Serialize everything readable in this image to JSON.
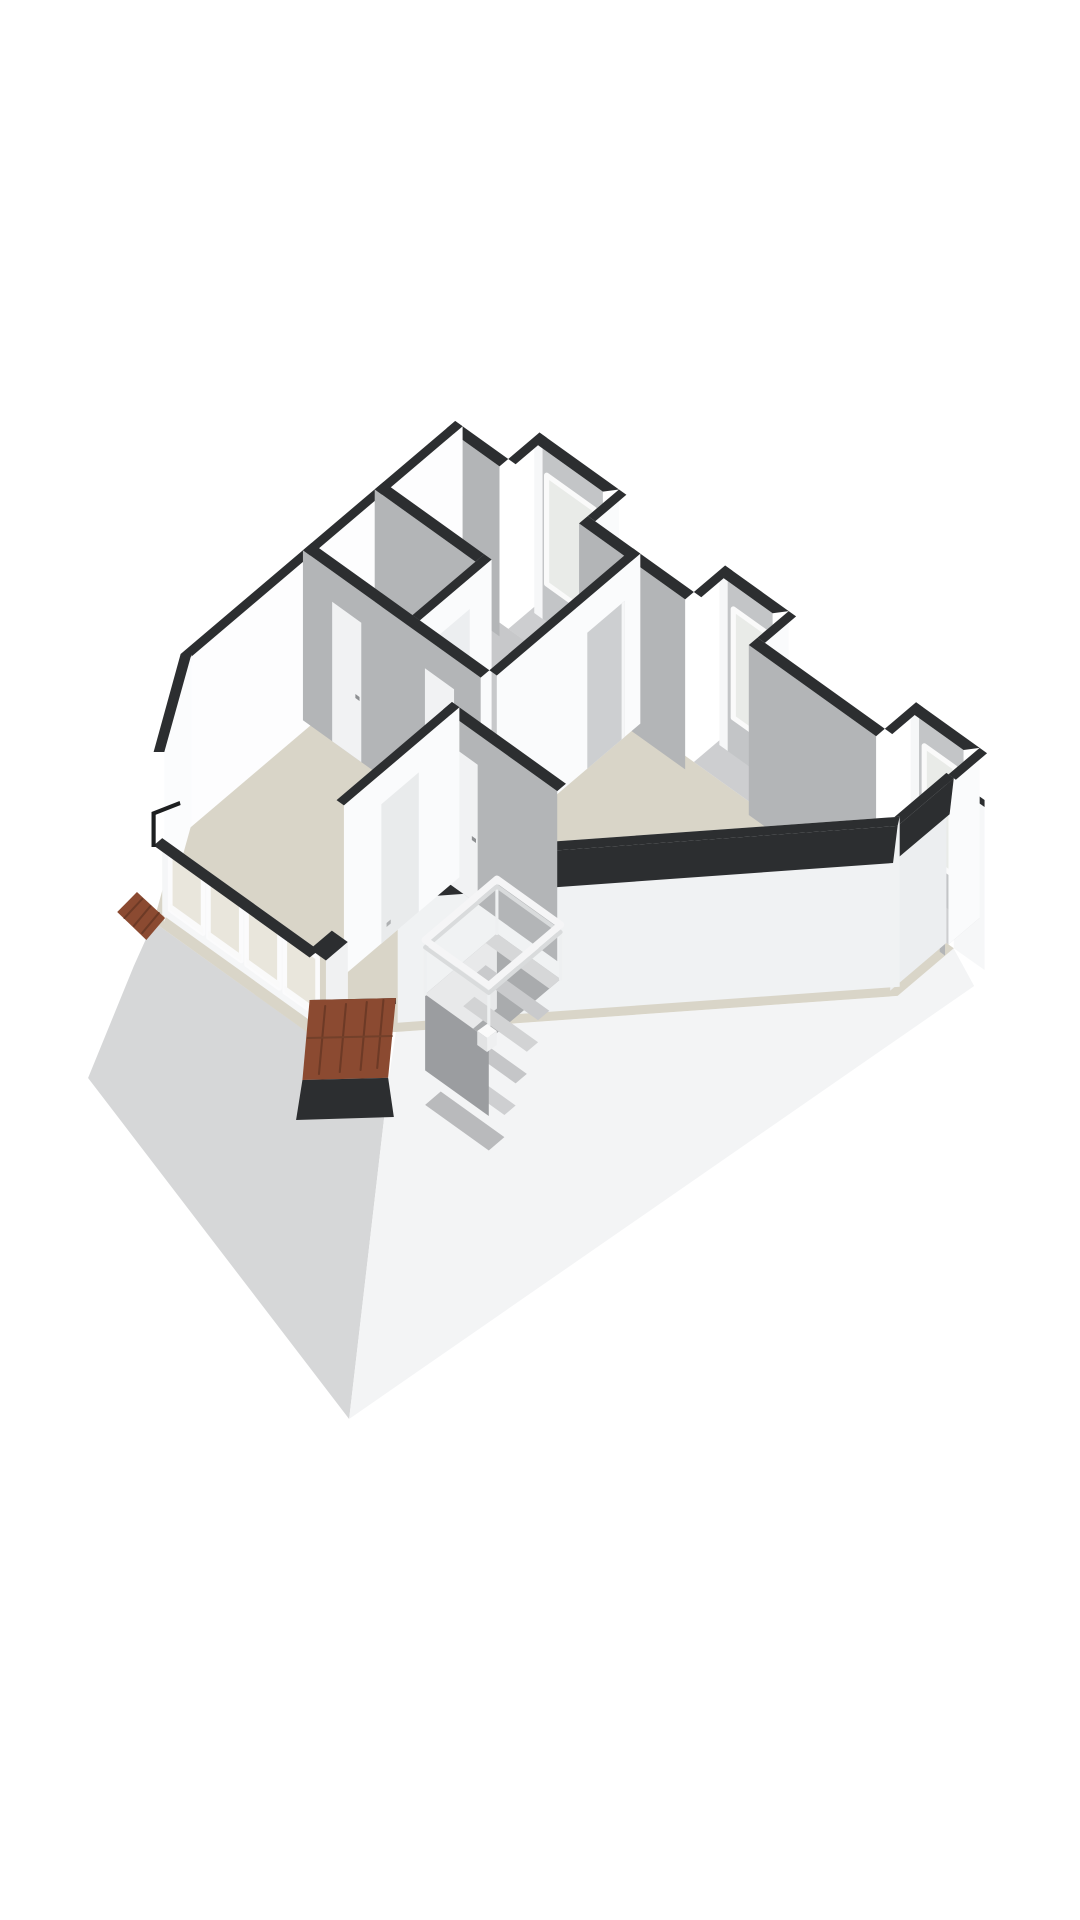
{
  "page": {
    "background": "#ffffff",
    "title": "3D floor plan rendering"
  },
  "palette": {
    "wall_cap_dark": "#2c2e30",
    "wall_white": "#fbfcfd",
    "wall_gray": "#b3b5b7",
    "floor_beige": "#d9d5c8",
    "floor_shadow_gray": "#c7c8ca",
    "roof_tiles_terracotta": "#8b4a31",
    "glass": "#e9e6dc",
    "railing_white": "#f5f5f6",
    "exterior_skirt_white": "#f3f4f5",
    "exterior_skirt_gray": "#d6d7d8"
  },
  "scene": {
    "width": 1080,
    "height": 1920,
    "transform": "translate(-70,6) scale(1.04,1)",
    "shapes": [
      {
        "n": "exterior-skirt-southwest",
        "f": "#d6d7d8",
        "p": "215,916 368,1030 441,1073 403,1413 152,1072 196,960"
      },
      {
        "n": "exterior-skirt-southeast",
        "f": "#f3f4f5",
        "p": "984,942 1004,980 403,1413 441,1073 448,1026 930,990"
      },
      {
        "n": "exterior-face-right",
        "f": "#f6f7f8",
        "p": "984.4,942.2 984.4,772.2 1014,794 1014,964"
      },
      {
        "n": "exterior-cap-right",
        "f": "#2c2e30",
        "p": "984.4,772.2 1014,794 1014,801 984.4,779.2"
      },
      {
        "n": "floor-slab",
        "f": "#d9d5c8",
        "p": "505,585 984.4,942.2 930.4,989.9 448,1026 365,1028 215,916 241,818"
      },
      {
        "n": "floor-small-rooms",
        "f": "#c7c8ca",
        "p": "505,585 676,712 538,834 367,707"
      },
      {
        "n": "dormer-a-floor",
        "f": "#cdced0",
        "p": "586,596.5 662.5,653.5 632.5,680 556,623"
      },
      {
        "n": "dormer-a-back-wall",
        "f": "#c3c5c7",
        "p": "584.7,609.2 647,655.6 647,485.6 584.7,439.2"
      },
      {
        "n": "dormer-a-window",
        "f": "#e9ebe8",
        "s": "#fafafa",
        "w": 5,
        "p": "592.9,577.9 638.8,612.1 638.8,503.3 592.9,469.1"
      },
      {
        "n": "dormer-a-jamb",
        "f": "#f6f7f8",
        "p": "581,607 589,613 589,440 581,434"
      },
      {
        "n": "dormer-a-sidewall",
        "f": "#fafbfc",
        "p": "662.5,653.5 632.5,680 632.5,510 662.5,483.5"
      },
      {
        "n": "dormer-a-cap-front",
        "f": "#2c2e30",
        "p": "586,426.5 662.5,483.5 647,485.6 584.7,439.2"
      },
      {
        "n": "dormer-a-cap-left",
        "f": "#2c2e30",
        "p": "586,426.5 556,453 563.1,458.3 593.1,431.8"
      },
      {
        "n": "dormer-a-cap-right",
        "f": "#2c2e30",
        "p": "662.5,483.5 632.5,510 639.6,515.3 669.6,488.8"
      },
      {
        "n": "wall-ne-a-face",
        "f": "#b3b5b7",
        "p": "496.6,592.4 547.6,630.4 547.6,460.4 496.6,422.4"
      },
      {
        "n": "wall-ne-a-cap",
        "f": "#2c2e30",
        "p": "505,415 556,453 547.6,460.4 496.6,422.4"
      },
      {
        "n": "wall-ne-b-face",
        "f": "#b3b5b7",
        "p": "624.1,687.4 726.1,763.4 726.1,593.4 624.1,517.4"
      },
      {
        "n": "wall-ne-b-cap",
        "f": "#2c2e30",
        "p": "632.5,510 734.5,586 726.1,593.4 624.1,517.4"
      },
      {
        "n": "dormer-b-floor",
        "f": "#cdced0",
        "p": "764.5,729.5 841,786.5 811,813 734.5,756"
      },
      {
        "n": "dormer-b-back-wall",
        "f": "#c3c5c7",
        "p": "763.2,742.2 810.2,777.2 810.2,607.2 763.2,572.2"
      },
      {
        "n": "dormer-b-window",
        "f": "#e9ebe8",
        "s": "#fafafa",
        "w": 5,
        "p": "772.4,711.7 807.1,737.5 807.1,628.7 772.4,602.9"
      },
      {
        "n": "dormer-b-jamb",
        "f": "#f6f7f8",
        "p": "759,739 767,745 767,572 759,566"
      },
      {
        "n": "dormer-b-sidewall",
        "f": "#fafbfc",
        "p": "825.7,775.1 795.7,801.6 795.7,631.6 825.7,605.1"
      },
      {
        "n": "dormer-b-cap-front",
        "f": "#2c2e30",
        "p": "764.5,559.5 825.7,605.1 810.2,607.2 763.2,572.2"
      },
      {
        "n": "dormer-b-cap-left",
        "f": "#2c2e30",
        "p": "764.5,559.5 734.5,586 741.6,591.3 771.6,564.8"
      },
      {
        "n": "dormer-b-cap-right",
        "f": "#2c2e30",
        "p": "825.7,605.1 795.7,631.6 802.8,636.9 832.8,610.4"
      },
      {
        "n": "wall-ne-c-face",
        "f": "#b3b5b7",
        "p": "787.3,809 909.7,900.2 909.7,730.2 787.3,639"
      },
      {
        "n": "wall-ne-c-cap",
        "f": "#2c2e30",
        "p": "795.7,631.6 918.1,722.8 909.7,730.2 787.3,639"
      },
      {
        "n": "dormer-c-floor",
        "f": "#cdced0",
        "p": "948.1,866.3 1009.3,911.9 979.3,938.4 918.1,892.8"
      },
      {
        "n": "dormer-c-back-wall",
        "f": "#c3c5c7",
        "p": "946.8,879 993.8,914 993.8,744 946.8,709"
      },
      {
        "n": "dormer-c-window",
        "f": "#e9ebe8",
        "s": "#fafafa",
        "w": 5,
        "p": "956,848.5 985.6,870.5 985.6,761.7 956,739.7"
      },
      {
        "n": "dormer-c-jamb",
        "f": "#f6f7f8",
        "p": "943,876 951,882 951,709 943,703"
      },
      {
        "n": "dormer-c-sidewall",
        "f": "#fafbfc",
        "p": "1009.3,911.9 979.3,938.4 979.3,768.4 1009.3,741.9"
      },
      {
        "n": "dormer-c-cap-front",
        "f": "#2c2e30",
        "p": "948.1,696.3 1009.3,741.9 993.8,744 946.8,709"
      },
      {
        "n": "dormer-c-cap-left",
        "f": "#2c2e30",
        "p": "948.1,696.3 918.1,722.8 925.2,728.1 955.2,701.6"
      },
      {
        "n": "dormer-c-cap-right",
        "f": "#2c2e30",
        "p": "1009.3,741.9 979.3,768.4 986.4,773.7 1016.4,747.2"
      },
      {
        "n": "wall-ne-d-face",
        "f": "#b3b5b7",
        "p": "970.9,945.8 976,949.6 976,779.6 970.9,775.8"
      },
      {
        "n": "wall-ne-d-cap",
        "f": "#2c2e30",
        "p": "979.3,768.4 984.4,772.2 976,779.6 970.9,775.8"
      },
      {
        "n": "wall-se-face",
        "f": "#eceef0",
        "p": "977.3,936.9 923.3,984.6 923.3,814.6 977.3,766.9"
      },
      {
        "n": "wall-se-cap",
        "f": "#2c2e30",
        "p": "984.4,772.2 930.4,819.9 923.3,814.6 977.3,766.9"
      },
      {
        "n": "wall-se-cap-outer",
        "f": "#2c2e30",
        "p": "984.4,772.2 930.4,819.9 926,856 980.4,808.2"
      },
      {
        "n": "wall-bevel-se-face",
        "f": "#f0f2f3",
        "p": "932.4,980.7 449.7,1016.7 449.7,846.7 932.4,810.7"
      },
      {
        "n": "wall-bevel-se-cap",
        "f": "#2c2e30",
        "p": "930.4,819.9 448,856 449.7,846.7 932.4,810.7"
      },
      {
        "n": "wall-bevel-se-cap-outer",
        "f": "#2c2e30",
        "p": "930.4,819.9 448,856 444,893 926,857"
      },
      {
        "n": "wall-nw-face",
        "f": "#fdfdfe",
        "p": "512.1,590.3 248.1,823.5 248.1,653.5 512.1,420.3"
      },
      {
        "n": "wall-nw-cap",
        "f": "#2c2e30",
        "p": "505,415 241,648 248.1,653.5 512.1,420.3"
      },
      {
        "n": "wall-bevel-left-face",
        "f": "#fbfcfd",
        "p": "251.4,818.2 225.3,916 225.3,746 251.4,648.2"
      },
      {
        "n": "wall-bevel-left-cap",
        "f": "#2c2e30",
        "p": "241,648 215,746 225.3,746 251.4,648.2"
      },
      {
        "n": "roof-tiles-left",
        "f": "#8b4a31",
        "p": "199,886 226,912 208,934 180,906"
      },
      {
        "n": "roof-tiles-left-ridge-1",
        "f": "none",
        "s": "#6d3a26",
        "w": 2,
        "p": "204,893 187,912"
      },
      {
        "n": "roof-tiles-left-ridge-2",
        "f": "none",
        "s": "#6d3a26",
        "w": 2,
        "p": "212,900 196,920"
      },
      {
        "n": "roof-tiles-left-ridge-3",
        "f": "none",
        "s": "#6d3a26",
        "w": 2,
        "p": "220,907 204,927"
      },
      {
        "n": "wall-small-rooms-divider-face",
        "f": "#b3b5b7",
        "p": "427.6,653.4 524.5,725.6 524.5,555.6 427.6,483.4"
      },
      {
        "n": "wall-small-rooms-divider-cap",
        "f": "#2c2e30",
        "p": "436,476 532.9,548.2 524.5,555.6 427.6,483.4"
      },
      {
        "n": "wall-small-rooms-return-face",
        "f": "#fafbfc",
        "p": "540,723.5 471,784.4 471,614.4 540,553.5"
      },
      {
        "n": "wall-small-rooms-return-cap",
        "f": "#2c2e30",
        "p": "532.9,548.2 463.9,609.1 471,614.4 540,553.5"
      },
      {
        "n": "door-small-room",
        "f": "#eceef0",
        "p": "519,742 489,768.5 489,629.5 519,603"
      },
      {
        "n": "door-small-room-handle",
        "f": "#9a9c9e",
        "p": "493,749 497,745.5 497,741.5 493,745"
      },
      {
        "n": "wall-partition-main-face",
        "f": "#fafbfc",
        "p": "683,717.6 545,839.5 545,669.5 683,547.6"
      },
      {
        "n": "doorway-opening",
        "f": "#cdcfd1",
        "p": "668,730.9 632,762.7 632,626.7 668,594.9"
      },
      {
        "n": "doorway-jamb-edge",
        "f": "#f6f7f8",
        "p": "668,730.9 665,733.6 665,597.6 668,594.9"
      },
      {
        "n": "wall-partition-main-cap",
        "f": "#2c2e30",
        "p": "675.9,542.3 537.9,664.2 545,669.5 683,547.6"
      },
      {
        "n": "wall-hall-face",
        "f": "#b3b5b7",
        "p": "358.6,714.3 529.5,841.6 529.5,671.6 358.6,544.3"
      },
      {
        "n": "door-left-room-1",
        "f": "#f1f2f3",
        "p": "386.7,735.2 414.7,756.1 414.7,616.7 386.7,595.8"
      },
      {
        "n": "door-left-room-1-handle",
        "f": "#8e9092",
        "p": "409,688 413,691 413,695 409,692"
      },
      {
        "n": "door-left-room-2",
        "f": "#f1f2f3",
        "p": "475.9,801.7 503.9,822.6 503.9,683.2 475.9,662.3"
      },
      {
        "n": "door-left-room-2-handle",
        "f": "#8e9092",
        "p": "498,754 502,757 502,761 498,758"
      },
      {
        "n": "wall-hall-cap",
        "f": "#2c2e30",
        "p": "367,536.9 537.9,664.2 529.5,671.6 358.6,544.3"
      },
      {
        "n": "wall-stair-north-face",
        "f": "#b3b5b7",
        "p": "493.5,873.4 603.1,955.1 603.1,785.1 493.5,703.4"
      },
      {
        "n": "door-stair-north",
        "f": "#f1f2f3",
        "p": "498.6,877.2 526.6,898.1 526.6,758.7 498.6,737.8"
      },
      {
        "n": "door-stair-north-handle",
        "f": "#8e9092",
        "p": "521,830 525,833 525,837 521,834"
      },
      {
        "n": "wall-stair-north-cap",
        "f": "#2c2e30",
        "p": "501.9,696 611.5,777.7 603.1,785.1 493.5,703.4"
      },
      {
        "n": "wall-stair-west-face",
        "f": "#fafbfc",
        "p": "509,871.3 398,969.4 398,799.4 509,701.3"
      },
      {
        "n": "door-stair-west",
        "f": "#e9ebec",
        "p": "470,905.8 434,937.6 434,798.2 470,766.4"
      },
      {
        "n": "door-stair-west-handle",
        "f": "#aeb0b2",
        "p": "439,921 443,917.5 443,913.5 439,917"
      },
      {
        "n": "wall-stair-west-cap",
        "f": "#2c2e30",
        "p": "501.9,696 390.9,794.1 398,799.4 509,701.3"
      },
      {
        "n": "stairwell-opening",
        "f": "#a9abad",
        "p": "545.1,927.5 606.3,973.1 537.3,1034 476.1,988.4"
      },
      {
        "n": "stairwell-inner-face-nw",
        "f": "#e8e9ea",
        "p": "545.1,927.5 476.1,988.4 476.1,1063.4 545.1,1002.5"
      },
      {
        "n": "stair-tread-1",
        "f": "#d6d7d8",
        "p": "545.1,927.5 606.3,973.1 595.5,982.6 534.3,937"
      },
      {
        "n": "stair-tread-2",
        "f": "#c9cacc",
        "p": "534.3,959.1 595.5,1004.7 584.7,1014.3 523.5,968.6"
      },
      {
        "n": "stair-tread-3",
        "f": "#d2d3d4",
        "p": "523.5,990.7 584.7,1036.3 573.9,1045.8 512.7,1000.2"
      },
      {
        "n": "stair-tread-4",
        "f": "#c5c6c8",
        "p": "512.7,1022.3 573.9,1067.9 563.1,1077.4 501.9,1031.8"
      },
      {
        "n": "stair-tread-5",
        "f": "#cecfd1",
        "p": "501.9,1053.9 563.1,1099.5 552.3,1109 491.1,1063.4"
      },
      {
        "n": "stair-tread-6",
        "f": "#b9babc",
        "p": "491.1,1085.5 552.3,1131.1 537.3,1144.5 476.1,1098.9"
      },
      {
        "n": "stairwell-inner-face-sw",
        "f": "#9b9da0",
        "p": "476.1,988.4 537.3,1034 537.3,1110 476.1,1064.4"
      },
      {
        "n": "railing-post-1",
        "f": "none",
        "s": "#eef0f1",
        "w": 3,
        "p": "545.1,927.5 545.1,873.1"
      },
      {
        "n": "railing-post-2",
        "f": "none",
        "s": "#eef0f1",
        "w": 3,
        "p": "606.3,973.1 606.3,918.7"
      },
      {
        "n": "railing-post-3",
        "f": "none",
        "s": "#eef0f1",
        "w": 3,
        "p": "537.3,1034 537.3,979.6"
      },
      {
        "n": "railing-post-4",
        "f": "none",
        "s": "#eef0f1",
        "w": 3,
        "p": "476.1,988.4 476.1,934"
      },
      {
        "n": "railing-lower-rail",
        "f": "none",
        "s": "#d9dbdc",
        "w": 4,
        "close": true,
        "p": "545.1,880.5 606.3,926.1 537.3,987 476.1,941.4"
      },
      {
        "n": "railing-top-rail",
        "f": "none",
        "s": "#f5f5f6",
        "w": 7,
        "close": true,
        "p": "545.1,873.1 606.3,918.7 537.3,979.6 476.1,934"
      },
      {
        "n": "newel-block-top",
        "f": "#fafafa",
        "p": "535.6,1018 545,1025 535.6,1032 526.2,1025"
      },
      {
        "n": "newel-block-left",
        "f": "#e2e3e4",
        "p": "526.2,1025 535.6,1032 535.6,1046 526.2,1039"
      },
      {
        "n": "newel-block-right",
        "f": "#eff0f1",
        "p": "535.6,1032 545,1025 545,1039 535.6,1046"
      },
      {
        "n": "wall-knee-window-face",
        "f": "#f5f6f7",
        "p": "223.3,908.6 373.8,1020.7 373.8,944.2 223.3,832.1"
      },
      {
        "n": "window-1",
        "f": "#e9e6dc",
        "s": "#fbfbfc",
        "w": 4.5,
        "p": "231,904.1 262.6,927.7 262.6,869.9 231,846.3"
      },
      {
        "n": "window-1-sill",
        "f": "#fafafa",
        "p": "231,904.1 262.6,927.7 262.6,921.2 231,897.6"
      },
      {
        "n": "window-2",
        "f": "#e9e6dc",
        "s": "#fbfbfc",
        "w": 4.5,
        "p": "267.7,931.5 299.3,955 299.3,897.2 267.7,873.7"
      },
      {
        "n": "window-2-sill",
        "f": "#fafafa",
        "p": "267.7,931.5 299.3,955 299.3,948.5 267.7,925"
      },
      {
        "n": "window-3",
        "f": "#e9e6dc",
        "s": "#fbfbfc",
        "w": 4.5,
        "p": "304.4,958.8 336,982.4 336,924.5 304.4,900.9"
      },
      {
        "n": "window-3-sill",
        "f": "#fafafa",
        "p": "304.4,958.8 336,982.4 336,975.9 304.4,952.3"
      },
      {
        "n": "window-4",
        "f": "#e9e6dc",
        "s": "#fbfbfc",
        "w": 4.5,
        "p": "341.1,986.2 372.7,1009.7 372.7,951.8 341.1,928.3"
      },
      {
        "n": "window-4-sill",
        "f": "#fafafa",
        "p": "341.1,986.2 372.7,1009.7 372.7,1003.2 341.1,979.7"
      },
      {
        "n": "wall-knee-window-cap",
        "f": "#2c2e30",
        "p": "215,839.5 365,951.5 373.8,944.2 223.3,832.1"
      },
      {
        "n": "pillar-ne-face",
        "f": "#fbfbfc",
        "p": "386.4,1009.6 401.7,1021 401.7,936 386.4,924.6"
      },
      {
        "n": "pillar-se-face",
        "f": "#f0f1f2",
        "p": "401.7,1021 380.7,1039.5 380.7,954.5 401.7,936"
      },
      {
        "n": "pillar-cap",
        "f": "#2c2e30",
        "p": "386.4,924.6 401.7,936 380.7,954.5 365.4,943.1"
      },
      {
        "n": "roof-tiles-bottom-edge-top",
        "f": "#2c2e30",
        "p": "448,992 365,994 365.4,1000 448,998"
      },
      {
        "n": "roof-tiles-bottom",
        "f": "#8b4a31",
        "p": "448,992 365,994 358.1,1074 440.5,1071.8"
      },
      {
        "n": "roof-tiles-bottom-ridge-1",
        "f": "none",
        "s": "#6d3a26",
        "w": 2,
        "p": "380,1000 374,1068"
      },
      {
        "n": "roof-tiles-bottom-ridge-2",
        "f": "none",
        "s": "#6d3a26",
        "w": 2,
        "p": "400,998 394,1066"
      },
      {
        "n": "roof-tiles-bottom-ridge-3",
        "f": "none",
        "s": "#6d3a26",
        "w": 2,
        "p": "420,996 414,1064"
      },
      {
        "n": "roof-tiles-bottom-ridge-4",
        "f": "none",
        "s": "#6d3a26",
        "w": 2,
        "p": "436,994 430,1062"
      },
      {
        "n": "roof-tiles-bottom-course",
        "f": "none",
        "s": "#73402a",
        "w": 2,
        "p": "363,1032 444,1030"
      },
      {
        "n": "roof-tiles-bottom-cap",
        "f": "#2c2e30",
        "p": "440.5,1071.8 358.1,1074 352,1114 446,1111"
      },
      {
        "n": "vent-rod-vertical",
        "f": "#1d1f20",
        "p": "213,806 217,806 217,841 213,841"
      },
      {
        "n": "vent-rod-horizontal",
        "f": "#1d1f20",
        "p": "213,806 240,795 241,799 214,810"
      }
    ]
  }
}
